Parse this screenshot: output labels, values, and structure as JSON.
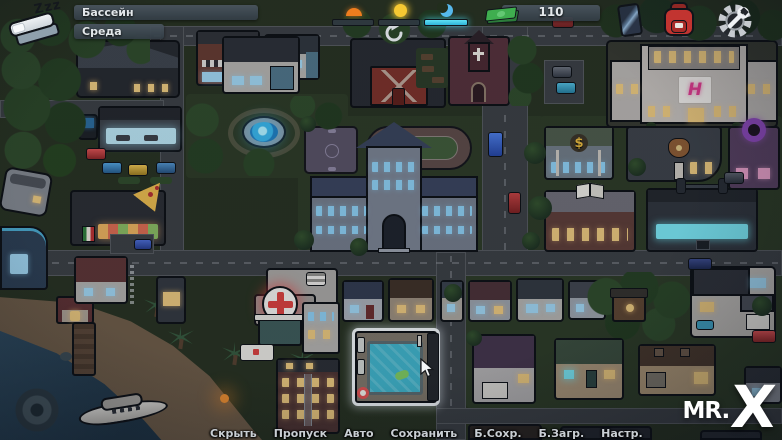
{
  "hud": {
    "sleep_zzz": "Zzz",
    "sleep_icon": "bed-icon",
    "location_label": "Бассейн",
    "day_label": "Среда",
    "time_widget": {
      "slots": [
        {
          "icon": "sunrise-icon",
          "active": false
        },
        {
          "icon": "sun-icon",
          "active": false
        },
        {
          "icon": "moon-icon",
          "active": true
        }
      ],
      "active_color": "#49d2ec"
    },
    "money": {
      "value": "110",
      "icon": "cash-icon",
      "color": "#3fae4f"
    },
    "phone_icon": "smartphone-icon",
    "inventory_icon": "backpack-icon",
    "settings_icon": "gear-wrench-icon",
    "refresh_icon": "circular-arrow-icon",
    "cursor_icon": "arrow-pointer-icon"
  },
  "map": {
    "selected_location": "Бассейн",
    "signs": {
      "hotel": "H",
      "bank": "$"
    },
    "colors": {
      "pool_water": "#3fb2c8",
      "selection_highlight": "#eef3f5",
      "fountain_glow": "#4fc3f0",
      "hospital_cross": "#d8403c",
      "gym_windows": "#79e4f1",
      "hotel_logo_pink": "#df3a8e",
      "night_road": "#3a3e42",
      "night_grass": "#273120"
    }
  },
  "quick_menu": {
    "items": [
      "Скрыть",
      "Пропуск",
      "Авто",
      "Сохранить",
      "Б.Сохр.",
      "Б.Загр.",
      "Настр."
    ]
  },
  "watermark": {
    "prefix": "MR.",
    "x": "X"
  }
}
